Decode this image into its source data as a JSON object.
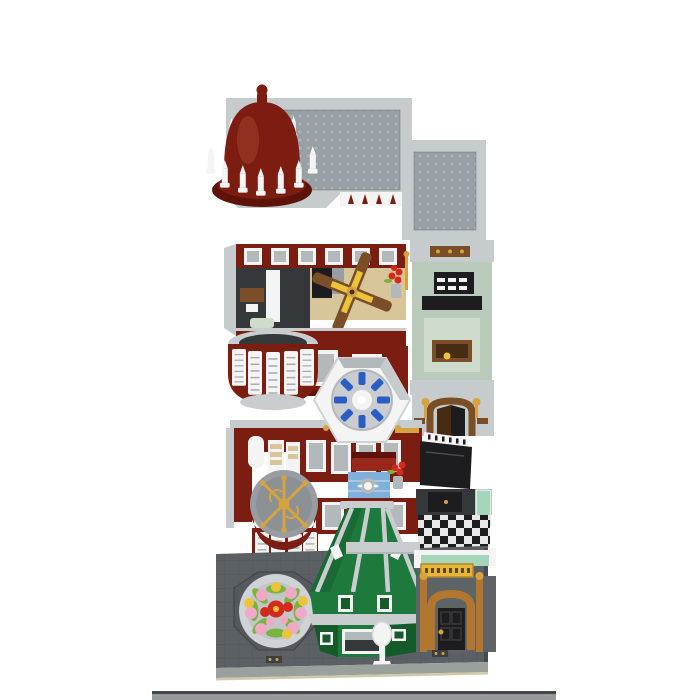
{
  "scene": {
    "type": "product-image",
    "subject": "Brick-built modular corner hotel shown as an exploded view: studded roof with dark red dome, two dark-red interior floors, and a street-level base plate",
    "background": "#ffffff",
    "levels": [
      {
        "id": "roof-level",
        "description": "Flat studded grey roof plate with corner dome in dark red surrounded by white pinnacles"
      },
      {
        "id": "second-floor-module",
        "description": "Open-top upper floor: dark red walls, ceiling fan, bay-window turret, sage green side room, arched restaurant doorway and white rotunda skylight with blue seats"
      },
      {
        "id": "first-floor-module",
        "description": "Middle floor: white cabinets, gold emblem turret, red sofa, blue plunge pool, grand piano room and black-and-white checkered floor"
      },
      {
        "id": "ground-level",
        "description": "Grey street base plate with round flower bed, green corner kiosk, white street lamp and arched hotel entrance with yellow sign"
      }
    ],
    "bottom_edge_note": "top sliver of the next gallery photo visible at the bottom of the screenshot"
  },
  "colors": {
    "background": "#ffffff",
    "plate_gray": "#99a1a6",
    "stud_gray": "#a9b0b4",
    "wall_light_gray": "#c6cbce",
    "trim_gray": "#b3b8bb",
    "mid_gray": "#979da1",
    "disc_gray": "#8b9195",
    "slab_gray": "#c9cdd0",
    "shutter_line": "#a8adb0",
    "dark_red": "#7c1d11",
    "deep_red": "#5d130a",
    "red_accent": "#99281a",
    "dome_red": "#7d1c10",
    "dome_highlight": "#a84b36",
    "white_piece": "#f4f4f4",
    "sage_wall": "#b9cabb",
    "sage_light": "#cfdccd",
    "black_piece": "#1d1d1f",
    "dark_interior": "#35383b",
    "green_shop": "#1e7a3c",
    "green_dark": "#145a2b",
    "trans_green": "#a5d6ba",
    "base_gray": "#5b6064",
    "base_dark": "#474b4f",
    "tile_line": "#4e5256",
    "octagon_gray": "#55595d",
    "planter_gray": "#d0d3d5",
    "planter_inner": "#c3c6c8",
    "flower_pink": "#efa8c5",
    "flower_red": "#d32a1b",
    "flower_yellow": "#edc33c",
    "leaf_green": "#79b43d",
    "beige_floor": "#d8c59a",
    "wood_brown": "#7a4e27",
    "dark_brown": "#452c12",
    "gold": "#d7a33e",
    "tan_arch": "#b3762f",
    "blue_seat": "#2a5ec4",
    "water_blue": "#7fb0dc",
    "sign_yellow": "#e7b53b",
    "checker_light": "#e8e8e8",
    "entrance_wall": "#5e6366",
    "pavement_edge": "#9aa09b",
    "pavement_line": "#cfc9a8",
    "strip_gray": "#96999c",
    "strip_dark": "#454649"
  }
}
